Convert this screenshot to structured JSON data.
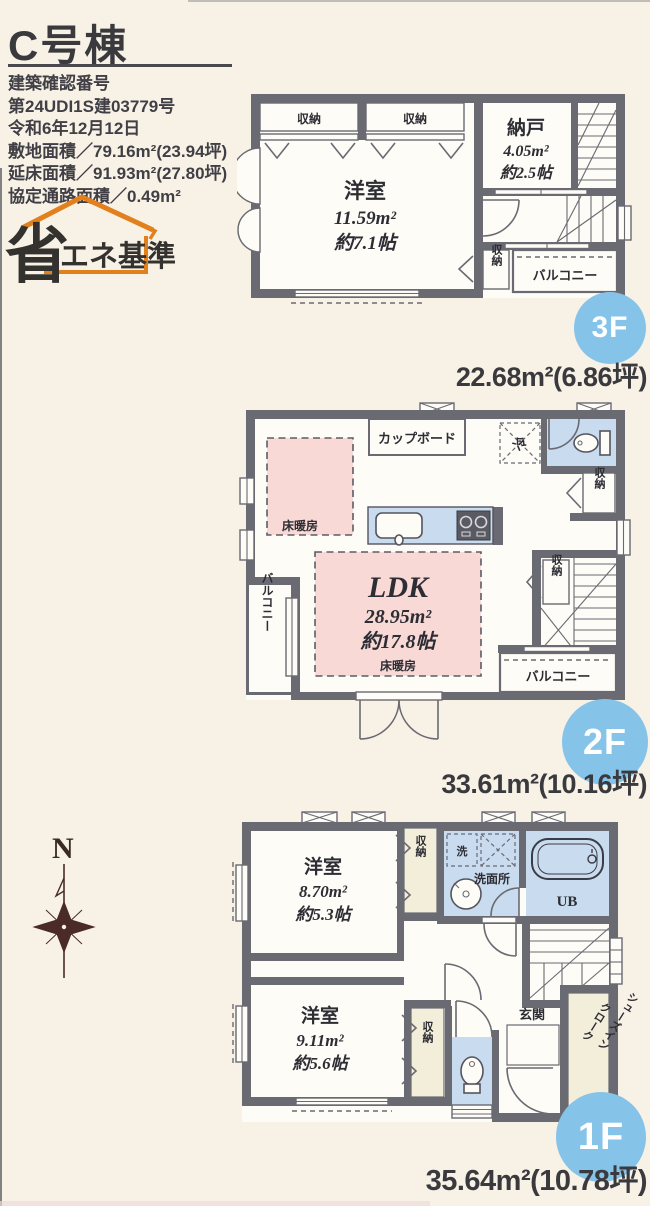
{
  "header": {
    "title": "C号棟",
    "lines": [
      "建築確認番号",
      "第24UDI1S建03779号",
      "令和6年12月12日",
      "敷地面積／79.16m²(23.94坪)",
      "延床面積／91.93m²(27.80坪)",
      "協定通路面積／0.49m²"
    ]
  },
  "eco_logo": {
    "big": "省",
    "small": "エネ基準"
  },
  "compass": {
    "label": "N"
  },
  "floor3": {
    "badge": "3F",
    "area": "22.68m²(6.86坪)",
    "labels": {
      "closet_a": "収納",
      "closet_b": "収納",
      "storage_name": "納戸",
      "storage_area": "4.05m²",
      "storage_tatami": "約2.5帖",
      "room_name": "洋室",
      "room_area": "11.59m²",
      "room_tatami": "約7.1帖",
      "closet_c": "収納",
      "balcony": "バルコニー"
    }
  },
  "floor2": {
    "badge": "2F",
    "area": "33.61m²(10.16坪)",
    "labels": {
      "cupboard": "カップボード",
      "fridge": "冷",
      "closet_a": "収納",
      "heating_a": "床暖房",
      "ldk_name": "LDK",
      "ldk_area": "28.95m²",
      "ldk_tatami": "約17.8帖",
      "heating_b": "床暖房",
      "closet_b": "収納",
      "balcony_left": "バルコニー",
      "balcony_bottom": "バルコニー"
    }
  },
  "floor1": {
    "badge": "1F",
    "area": "35.64m²(10.78坪)",
    "labels": {
      "room1_name": "洋室",
      "room1_area": "8.70m²",
      "room1_tatami": "約5.3帖",
      "closet_a": "収納",
      "laundry": "洗",
      "washroom": "洗面所",
      "bath": "UB",
      "room2_name": "洋室",
      "room2_area": "9.11m²",
      "room2_tatami": "約5.6帖",
      "closet_b": "収納",
      "entrance": "玄関",
      "shoes_line1": "シューズイン",
      "shoes_line2": "クローク"
    }
  },
  "colors": {
    "wall": "#6a6a72",
    "paper": "#f8f2e6",
    "heating_pink": "#f8d9d6",
    "water_blue": "#c9dbee",
    "closet_yellow": "#f3eeda",
    "badge_blue": "#85c3e8",
    "logo_orange": "#e2801d",
    "compass_brown": "#4a2b26"
  }
}
